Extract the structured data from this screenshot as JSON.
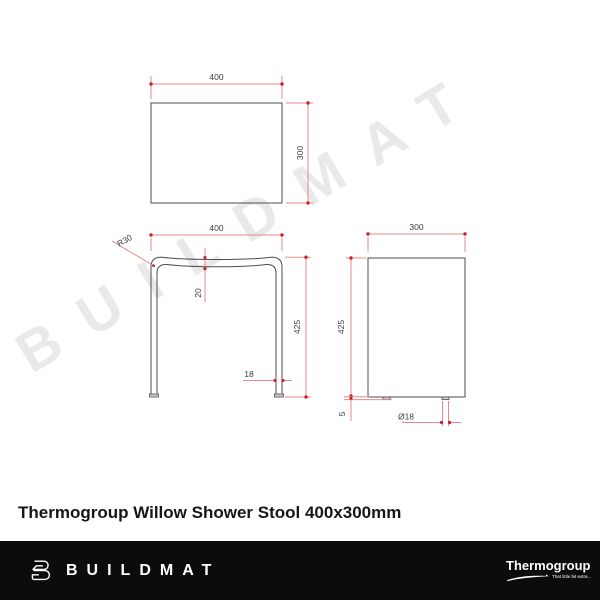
{
  "watermark": "BUILDMAT",
  "title": "Thermogroup Willow Shower Stool 400x300mm",
  "views": {
    "top": {
      "label": "top-view",
      "width": "400",
      "depth": "300"
    },
    "front": {
      "label": "front-view",
      "width": "400",
      "height": "425",
      "corner_radius": "R30",
      "seat_thickness": "20",
      "leg_width": "18"
    },
    "side": {
      "label": "side-view",
      "width": "300",
      "height": "425",
      "foot_height": "5",
      "foot_diameter": "Ø18"
    }
  },
  "footer": {
    "brand": "BUILDMAT",
    "supplier": "Thermogroup",
    "supplier_tagline": "That little bit extra..."
  },
  "colors": {
    "dim-line": "#e58a8a",
    "dim-accent": "#c8232c",
    "dim-text": "#3d3d3d",
    "object-line": "#4d4d4d",
    "watermark": "#e9e9e9",
    "footer-bg": "#0c0c0c",
    "footer-fg": "#ffffff",
    "title-color": "#161616"
  }
}
